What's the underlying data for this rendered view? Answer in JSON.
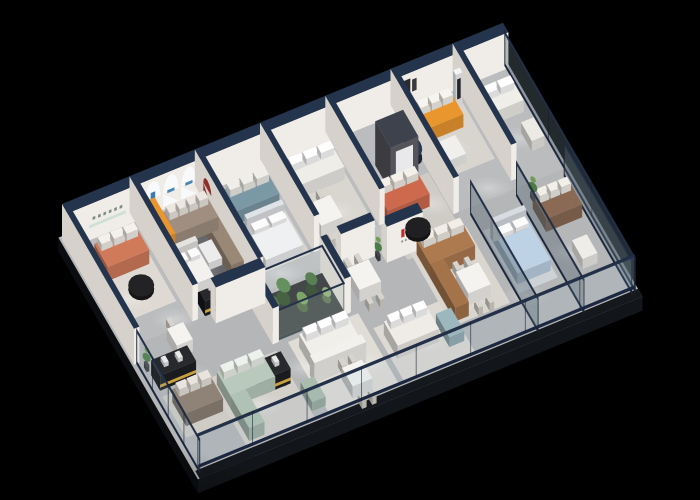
{
  "canvas": {
    "width": 700,
    "height": 500,
    "background": "#000000"
  },
  "scene": {
    "name": "furniture-showroom-isometric-cutaway-floorplan",
    "projection": {
      "origin": [
        62,
        240
      ],
      "u_axis": [
        0.45,
        -0.185
      ],
      "v_axis": [
        0.45,
        0.78
      ],
      "length": 980,
      "depth": 300,
      "wall_height": 36
    },
    "palette": {
      "background": "#000000",
      "floor": "#b4b6b8",
      "floor_back": "#bfc1c2",
      "slab_side": "#0b0d10",
      "slab_front": "#121519",
      "walk_strip": "#15181d",
      "wall_face": "#f0ede8",
      "wall_shadow": "#d6d2cb",
      "wall_cap_navy": "#25344d",
      "feature_wall_dark": "#54545a",
      "glass_rail_navy": "#1b2740",
      "glass_tint": "rgba(150,180,192,0.14)",
      "glass_partition_tint": "rgba(88,104,114,0.40)",
      "accent_orange": "#e9962e",
      "accent_coral": "#d07a5a",
      "accent_teal": "#7b98a6",
      "accent_sage": "#b9cabd",
      "accent_caramel": "#ad7a50",
      "accent_taupe": "#a08f81",
      "accent_blue_bed": "#bdd2e4",
      "brand_logo_red": "#c03028",
      "arch_logo_blue": "#3a7ab8",
      "black_counter": "#1c1c1e",
      "counter_stripe_gold": "#c9a23e",
      "plant_green_dark": "#4c7c46",
      "plant_green_light": "#719b57"
    },
    "walls": [
      {
        "n": "back-wall",
        "u1": 0,
        "v1": 0,
        "u2": 980,
        "v2": 12,
        "z": 2000
      },
      {
        "n": "left-end-wall",
        "u1": 0,
        "v1": 0,
        "u2": 12,
        "v2": 160
      },
      {
        "n": "partition-1",
        "u1": 150,
        "v1": 0,
        "u2": 162,
        "v2": 140
      },
      {
        "n": "partition-2",
        "u1": 295,
        "v1": 0,
        "u2": 307,
        "v2": 140
      },
      {
        "n": "partition-3",
        "u1": 440,
        "v1": 0,
        "u2": 452,
        "v2": 120
      },
      {
        "n": "partition-4",
        "u1": 585,
        "v1": 0,
        "u2": 597,
        "v2": 120
      },
      {
        "n": "partition-5",
        "u1": 730,
        "v1": 0,
        "u2": 742,
        "v2": 140
      },
      {
        "n": "partition-6",
        "u1": 868,
        "v1": 0,
        "u2": 880,
        "v2": 130
      },
      {
        "n": "display-wall-mid",
        "u1": 190,
        "v1": 140,
        "u2": 300,
        "v2": 152,
        "z": 155
      },
      {
        "n": "display-wall-tv",
        "u1": 470,
        "v1": 140,
        "u2": 545,
        "v2": 150
      },
      {
        "n": "logo-wall",
        "u1": 560,
        "v1": 150,
        "u2": 640,
        "v2": 162,
        "z": 600
      },
      {
        "n": "feature-wall",
        "u1": 640,
        "v1": 56,
        "u2": 702,
        "v2": 90,
        "h": 44,
        "dark": true
      },
      {
        "n": "terrarium-pillar-left",
        "u1": 270,
        "v1": 144,
        "u2": 284,
        "v2": 198
      },
      {
        "n": "terrarium-pillar-right",
        "u1": 430,
        "v1": 144,
        "u2": 444,
        "v2": 198
      }
    ],
    "glazing": [
      {
        "n": "front-glazing",
        "axis": "u",
        "at": 294,
        "p1": 8,
        "p2": 978,
        "h": 34,
        "mullions": 7,
        "fixed": true
      },
      {
        "n": "left-glazing",
        "axis": "v",
        "at": 6,
        "p1": 160,
        "p2": 300,
        "h": 34,
        "mullions": 3,
        "fixed": true
      },
      {
        "n": "glass-partition-a",
        "axis": "v",
        "at": 760,
        "p1": 148,
        "p2": 298,
        "h": 34,
        "mullions": 0,
        "tint": "dark"
      },
      {
        "n": "glass-partition-b",
        "axis": "v",
        "at": 862,
        "p1": 148,
        "p2": 298,
        "h": 34,
        "mullions": 0,
        "tint": "dark"
      },
      {
        "n": "glass-partition-c",
        "axis": "v",
        "at": 968,
        "p1": 148,
        "p2": 298,
        "h": 34,
        "mullions": 0,
        "tint": "dark"
      },
      {
        "n": "right-end-glazing",
        "axis": "v",
        "at": 976,
        "p1": 8,
        "p2": 298,
        "h": 34,
        "mullions": 2,
        "tint": "dark"
      }
    ],
    "decals": [
      {
        "n": "arch-light-panel-1",
        "k": "arch",
        "plane": "se",
        "at": 12,
        "cu": 190,
        "w": 17,
        "h0": 3,
        "h1": 33,
        "c": "#f7f9fb",
        "z": 1990
      },
      {
        "n": "arch-light-panel-2",
        "k": "arch",
        "plane": "se",
        "at": 12,
        "cu": 230,
        "w": 17,
        "h0": 3,
        "h1": 33,
        "c": "#f7f9fb",
        "z": 1990
      },
      {
        "n": "arch-light-panel-3",
        "k": "arch",
        "plane": "se",
        "at": 12,
        "cu": 270,
        "w": 17,
        "h0": 3,
        "h1": 33,
        "c": "#f7f9fb",
        "z": 1990
      },
      {
        "n": "arch-brand-mark-1",
        "k": "rect",
        "plane": "se",
        "at": 12,
        "u1": 185,
        "h1": 14,
        "u2": 195,
        "h2": 22,
        "c": "#3a7ab8",
        "z": 1989
      },
      {
        "n": "arch-brand-mark-2",
        "k": "rect",
        "plane": "se",
        "at": 12,
        "u1": 222,
        "h1": 15,
        "u2": 238,
        "h2": 18,
        "c": "#4a86b4",
        "z": 1989
      },
      {
        "n": "arch-brand-mark-3",
        "k": "rect",
        "plane": "se",
        "at": 12,
        "u1": 262,
        "h1": 15,
        "u2": 278,
        "h2": 18,
        "c": "#4a86b4",
        "z": 1989
      },
      {
        "n": "wall-sign-characters",
        "k": "dashes",
        "plane": "se",
        "at": 12,
        "u1": 56,
        "u2": 122,
        "h1": 19,
        "h2": 22,
        "nseg": 6,
        "c": "#7f8e86",
        "z": 1990
      },
      {
        "n": "wall-sign-ledge",
        "k": "rect",
        "plane": "se",
        "at": 12,
        "u1": 48,
        "h1": 12,
        "u2": 130,
        "h2": 15,
        "c": "#cfe0d4",
        "z": 1990
      },
      {
        "n": "art-frame-1",
        "k": "rect",
        "plane": "se",
        "at": 12,
        "u1": 748,
        "h1": 12,
        "u2": 762,
        "h2": 30,
        "c": "#2b2b2e",
        "z": 1990
      },
      {
        "n": "art-frame-2",
        "k": "rect",
        "plane": "se",
        "at": 12,
        "u1": 766,
        "h1": 16,
        "u2": 776,
        "h2": 28,
        "c": "#3a3a3e",
        "z": 1990
      },
      {
        "n": "red-arch-niche",
        "k": "arch",
        "plane": "sw",
        "at": 295,
        "cu": 28,
        "w": 9,
        "h0": 5,
        "h1": 27,
        "c": "#8e2f2a",
        "z": 268
      },
      {
        "n": "brand-logo-red-1",
        "k": "rect",
        "plane": "se",
        "at": 162,
        "u1": 592,
        "h1": 19,
        "u2": 599,
        "h2": 27,
        "c": "#c03028",
        "z": 599
      },
      {
        "n": "brand-logo-red-2",
        "k": "rect",
        "plane": "se",
        "at": 162,
        "u1": 603,
        "h1": 19,
        "u2": 610,
        "h2": 27,
        "c": "#c03028",
        "z": 599
      },
      {
        "n": "brand-logo-caption",
        "k": "dashes",
        "plane": "se",
        "at": 162,
        "u1": 592,
        "u2": 612,
        "h1": 14,
        "h2": 16,
        "nseg": 3,
        "c": "#8d8d8b",
        "z": 599
      },
      {
        "n": "feature-wall-inset",
        "k": "rect",
        "plane": "se",
        "at": 90,
        "u1": 652,
        "h1": 8,
        "u2": 690,
        "h2": 38,
        "c": "#e9e9ec",
        "z": 637
      },
      {
        "n": "standee-figure",
        "k": "rect",
        "plane": "se",
        "at": 32,
        "u1": 846,
        "h1": 9,
        "u2": 854,
        "h2": 29,
        "c": "#26262e",
        "z": 837
      }
    ],
    "rugs": [
      {
        "n": "rug-lounge-left",
        "u1": 28,
        "v1": 22,
        "u2": 142,
        "v2": 112,
        "c": "#ded9d2"
      },
      {
        "n": "rug-arch-room",
        "u1": 183,
        "v1": 22,
        "u2": 298,
        "v2": 118,
        "c": "#65676b"
      },
      {
        "n": "rug-lounge-teal",
        "u1": 318,
        "v1": 22,
        "u2": 432,
        "v2": 120,
        "c": "#d7d4ce"
      },
      {
        "n": "rug-lounge-4",
        "u1": 458,
        "v1": 22,
        "u2": 578,
        "v2": 120,
        "c": "#d9d6d0"
      },
      {
        "n": "rug-feature",
        "u1": 600,
        "v1": 86,
        "u2": 728,
        "v2": 168,
        "c": "#cfccc6"
      },
      {
        "n": "rug-corner",
        "u1": 745,
        "v1": 20,
        "u2": 862,
        "v2": 100,
        "c": "#d8d5cf"
      },
      {
        "n": "rug-left-front",
        "u1": 18,
        "v1": 205,
        "u2": 120,
        "v2": 258,
        "c": "#cfccc6"
      },
      {
        "n": "rug-sage",
        "u1": 118,
        "v1": 206,
        "u2": 270,
        "v2": 292,
        "c": "#d3d0ca"
      },
      {
        "n": "rug-pod",
        "u1": 300,
        "v1": 202,
        "u2": 456,
        "v2": 292,
        "c": "#e0ddd7"
      },
      {
        "n": "rug-family",
        "u1": 468,
        "v1": 224,
        "u2": 626,
        "v2": 294,
        "c": "#ddd9d3"
      },
      {
        "n": "rug-caramel",
        "u1": 612,
        "v1": 158,
        "u2": 740,
        "v2": 256,
        "c": "#d9d5cf"
      },
      {
        "n": "rug-bedroom",
        "u1": 766,
        "v1": 170,
        "u2": 852,
        "v2": 250,
        "c": "#cdd2d6"
      }
    ],
    "furniture": [
      {
        "n": "sofa-coral-left",
        "k": "sofa",
        "u1": 40,
        "v1": 32,
        "u2": 132,
        "v2": 62,
        "h": 14,
        "c": "#d07a5a",
        "cc": "#f4f1ec",
        "nc": 3
      },
      {
        "n": "coffee-table-black-left",
        "k": "disc",
        "cu": 88,
        "cv": 88,
        "ru": 26,
        "rv": 13,
        "h": 7,
        "c": "#232325"
      },
      {
        "n": "display-shelf-orange",
        "k": "box",
        "u1": 168,
        "v1": 14,
        "u2": 192,
        "v2": 60,
        "h": 18,
        "c": "#e9962e"
      },
      {
        "n": "bed-display-white",
        "k": "bed",
        "u1": 168,
        "v1": 70,
        "u2": 226,
        "v2": 112,
        "h": 9,
        "c": "#f2f1ee",
        "hb": "#e4e3df"
      },
      {
        "n": "sofa-taupe-arch",
        "k": "sofa",
        "u1": 195,
        "v1": 28,
        "u2": 292,
        "v2": 56,
        "h": 13,
        "c": "#a08f81",
        "cc": "#ece7e0",
        "nc": 4
      },
      {
        "n": "sofa-taupe-arch-return",
        "k": "box",
        "u1": 264,
        "v1": 56,
        "u2": 292,
        "v2": 112,
        "h": 13,
        "c": "#998876"
      },
      {
        "n": "coffee-table-white-arch",
        "k": "box",
        "u1": 232,
        "v1": 70,
        "u2": 262,
        "v2": 94,
        "h": 7,
        "c": "#ececec"
      },
      {
        "n": "sofa-teal",
        "k": "sofa",
        "u1": 328,
        "v1": 30,
        "u2": 425,
        "v2": 58,
        "h": 13,
        "c": "#7b98a6",
        "cc": "#f0eee9",
        "nc": 3
      },
      {
        "n": "plant-lounge-teal",
        "k": "plant",
        "cu": 312,
        "cv": 68,
        "r": 6
      },
      {
        "n": "bed-white",
        "k": "bed",
        "u1": 335,
        "v1": 70,
        "u2": 418,
        "v2": 118,
        "h": 10,
        "c": "#eef0f2",
        "hb": "#dfe2e6"
      },
      {
        "n": "sofa-white-lounge-4",
        "k": "sofa",
        "u1": 465,
        "v1": 30,
        "u2": 570,
        "v2": 58,
        "h": 13,
        "c": "#efede8",
        "cc": "#ffffff",
        "nc": 3
      },
      {
        "n": "dining-set-lounge-4",
        "k": "dining",
        "cu": 492,
        "cv": 94,
        "tw": 48,
        "td": 28
      },
      {
        "n": "sofa-coral-feature",
        "k": "sofa",
        "u1": 602,
        "v1": 92,
        "u2": 695,
        "v2": 122,
        "h": 13,
        "c": "#cd6a4d",
        "cc": "#f3efe9",
        "nc": 3
      },
      {
        "n": "coffee-table-black-feature",
        "k": "disc",
        "cu": 645,
        "cv": 146,
        "ru": 26,
        "rv": 12,
        "h": 7,
        "c": "#202022"
      },
      {
        "n": "side-table-navy",
        "k": "disc",
        "cu": 712,
        "cv": 68,
        "ru": 16,
        "rv": 13,
        "h": 16,
        "c": "#2b3a52"
      },
      {
        "n": "sofa-orange-corner",
        "k": "sofa",
        "u1": 755,
        "v1": 26,
        "u2": 838,
        "v2": 54,
        "h": 13,
        "c": "#e9962e",
        "cc": "#f6f4ef",
        "nc": 3
      },
      {
        "n": "table-white-corner",
        "k": "box",
        "u1": 765,
        "v1": 68,
        "u2": 806,
        "v2": 92,
        "h": 9,
        "c": "#f0efec"
      },
      {
        "n": "promoter-standee",
        "k": "box",
        "u1": 843,
        "v1": 26,
        "u2": 858,
        "v2": 32,
        "h": 34,
        "c": "#f4f4f4"
      },
      {
        "n": "sofa-white-right",
        "k": "sofa",
        "u1": 888,
        "v1": 38,
        "u2": 962,
        "v2": 64,
        "h": 12,
        "c": "#f0eee9",
        "cc": "#ffffff",
        "nc": 2
      },
      {
        "n": "armchair-white-right",
        "k": "box",
        "u1": 936,
        "v1": 84,
        "u2": 964,
        "v2": 108,
        "h": 10,
        "c": "#eceae5"
      },
      {
        "n": "sofa-brown-leather",
        "k": "sofa",
        "u1": 878,
        "v1": 168,
        "u2": 958,
        "v2": 198,
        "h": 13,
        "c": "#8a6a55",
        "cc": "#f2efe9",
        "nc": 3
      },
      {
        "n": "armchair-white-glassroom",
        "k": "box",
        "u1": 905,
        "v1": 228,
        "u2": 938,
        "v2": 252,
        "h": 10,
        "c": "#efede8"
      },
      {
        "n": "plant-glassroom",
        "k": "plant",
        "cu": 888,
        "cv": 158,
        "r": 8
      },
      {
        "n": "display-counter-mid",
        "k": "counter",
        "u1": 178,
        "v1": 118,
        "u2": 266,
        "v2": 140
      },
      {
        "n": "display-counter-front",
        "k": "counter",
        "u1": 198,
        "v1": 224,
        "u2": 262,
        "v2": 246
      },
      {
        "n": "display-counter-left",
        "k": "counter",
        "u1": 20,
        "v1": 178,
        "u2": 100,
        "v2": 198
      },
      {
        "n": "sofa-taupe-front",
        "k": "sofa",
        "u1": 30,
        "v1": 215,
        "u2": 112,
        "v2": 246,
        "h": 13,
        "c": "#8f8277",
        "cc": "#e9e4dd",
        "nc": 3
      },
      {
        "n": "sofa-sage",
        "k": "sofa",
        "u1": 128,
        "v1": 216,
        "u2": 228,
        "v2": 246,
        "h": 13,
        "c": "#b9cabd",
        "cc": "#eef2ec",
        "nc": 3
      },
      {
        "n": "sage-chaise",
        "k": "box",
        "u1": 128,
        "v1": 246,
        "u2": 162,
        "v2": 288,
        "h": 13,
        "c": "#b0c2b4"
      },
      {
        "n": "table-round-sage",
        "k": "disc",
        "cu": 246,
        "cv": 240,
        "ru": 14,
        "rv": 11,
        "h": 9,
        "c": "#f2f2f0"
      },
      {
        "n": "plant-sage-table",
        "k": "plant",
        "cu": 246,
        "cv": 238,
        "r": 5
      },
      {
        "n": "ottoman-sage",
        "k": "box",
        "u1": 272,
        "v1": 258,
        "u2": 302,
        "v2": 284,
        "h": 9,
        "c": "#a9bcae"
      },
      {
        "n": "terrarium-case",
        "k": "terrarium",
        "u1": 284,
        "v1": 148,
        "u2": 430,
        "v2": 196,
        "h": 30
      },
      {
        "n": "sofa-white-pod",
        "k": "sofa",
        "u1": 315,
        "v1": 212,
        "u2": 420,
        "v2": 242,
        "h": 13,
        "c": "#f1efea",
        "cc": "#ffffff",
        "nc": 3
      },
      {
        "n": "pod-partition",
        "k": "box",
        "u1": 305,
        "v1": 246,
        "u2": 420,
        "v2": 256,
        "h": 20,
        "c": "#f3f1ed",
        "z": 258
      },
      {
        "n": "dining-set-pod",
        "k": "dining",
        "cu": 380,
        "cv": 276,
        "tw": 44,
        "td": 24
      },
      {
        "n": "sofa-white-family",
        "k": "sofa",
        "u1": 480,
        "v1": 235,
        "u2": 572,
        "v2": 266,
        "h": 13,
        "c": "#efece7",
        "cc": "#ffffff",
        "nc": 3
      },
      {
        "n": "ottoman-blue",
        "k": "box",
        "u1": 585,
        "v1": 246,
        "u2": 618,
        "v2": 276,
        "h": 10,
        "c": "#9cb7bd"
      },
      {
        "n": "dining-set-family",
        "k": "dining",
        "cu": 494,
        "cv": 177,
        "tw": 48,
        "td": 28
      },
      {
        "n": "plant-logo-wall",
        "k": "plant",
        "cu": 548,
        "cv": 154,
        "r": 7
      },
      {
        "n": "sofa-caramel",
        "k": "sofa",
        "u1": 622,
        "v1": 166,
        "u2": 722,
        "v2": 196,
        "h": 14,
        "c": "#ad7a50",
        "cc": "#f2eee7",
        "nc": 3
      },
      {
        "n": "sofa-caramel-return",
        "k": "box",
        "u1": 622,
        "v1": 196,
        "u2": 652,
        "v2": 252,
        "h": 14,
        "c": "#a5734a"
      },
      {
        "n": "dining-set-caramel",
        "k": "dining",
        "cu": 687,
        "cv": 227,
        "tw": 50,
        "td": 28
      },
      {
        "n": "bed-blue",
        "k": "bed",
        "u1": 772,
        "v1": 180,
        "u2": 846,
        "v2": 240,
        "h": 11,
        "c": "#bdd2e4",
        "hb": "#d8dce2"
      },
      {
        "n": "dining-set-entry",
        "k": "dining",
        "cu": 102,
        "cv": 160,
        "tw": 36,
        "td": 22
      },
      {
        "n": "plant-left-end",
        "k": "plant",
        "cu": 18,
        "cv": 170,
        "r": 7
      }
    ],
    "light_spots": [
      [
        120,
        130
      ],
      [
        240,
        132
      ],
      [
        360,
        128
      ],
      [
        480,
        130
      ],
      [
        600,
        132
      ],
      [
        700,
        120
      ],
      [
        820,
        128
      ],
      [
        90,
        195
      ],
      [
        185,
        255
      ],
      [
        300,
        235
      ],
      [
        420,
        258
      ],
      [
        545,
        260
      ],
      [
        665,
        235
      ],
      [
        775,
        255
      ],
      [
        900,
        230
      ],
      [
        60,
        90
      ],
      [
        210,
        90
      ],
      [
        370,
        88
      ],
      [
        520,
        88
      ],
      [
        660,
        70
      ],
      [
        790,
        70
      ],
      [
        930,
        90
      ]
    ]
  }
}
